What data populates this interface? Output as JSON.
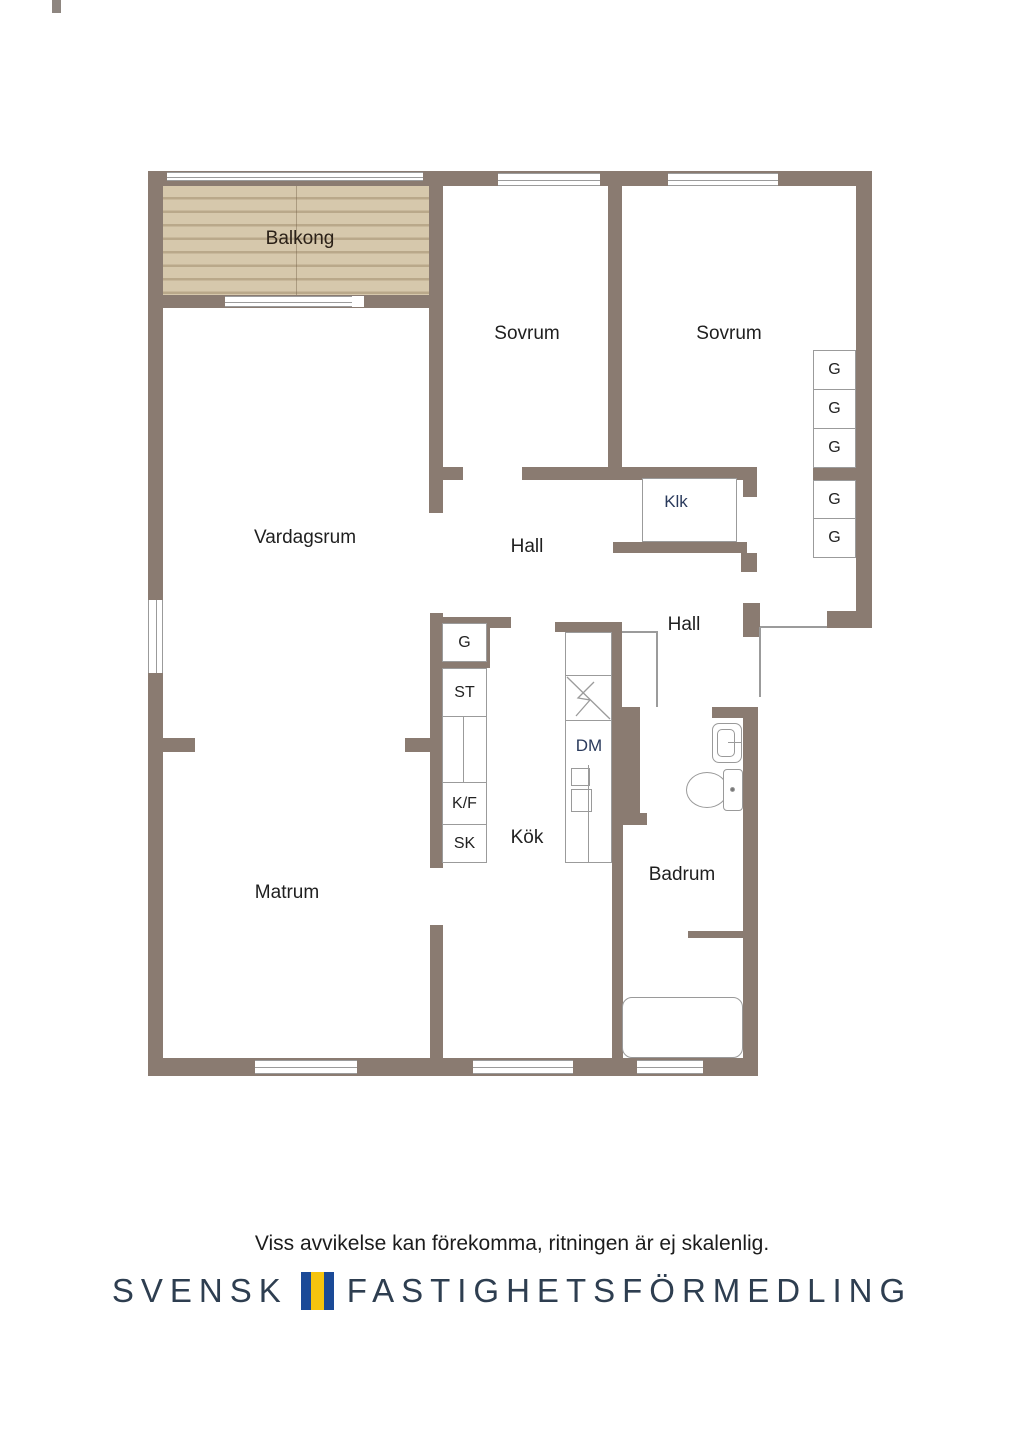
{
  "plan": {
    "rooms": {
      "balkong": "Balkong",
      "sovrum1": "Sovrum",
      "sovrum2": "Sovrum",
      "vardagsrum": "Vardagsrum",
      "hall1": "Hall",
      "klk": "Klk",
      "hall2": "Hall",
      "kok": "Kök",
      "matrum": "Matrum",
      "badrum": "Badrum"
    },
    "appliances": {
      "dm": "DM",
      "g_kitchen": "G",
      "st": "ST",
      "kf": "K/F",
      "sk": "SK",
      "wardrobes": [
        "G",
        "G",
        "G",
        "G",
        "G"
      ]
    },
    "colors": {
      "wall": "#8a7b71",
      "wood_floor": "#d0c2a6",
      "outline": "#9b9b9b"
    }
  },
  "footer": {
    "disclaimer": "Viss avvikelse kan förekomma, ritningen är ej skalenlig.",
    "brand_part1": "SVENSK",
    "brand_part2": "FASTIGHETSFÖRMEDLING",
    "flag_blue": "#1b4a97",
    "flag_yellow": "#f6c40e"
  }
}
